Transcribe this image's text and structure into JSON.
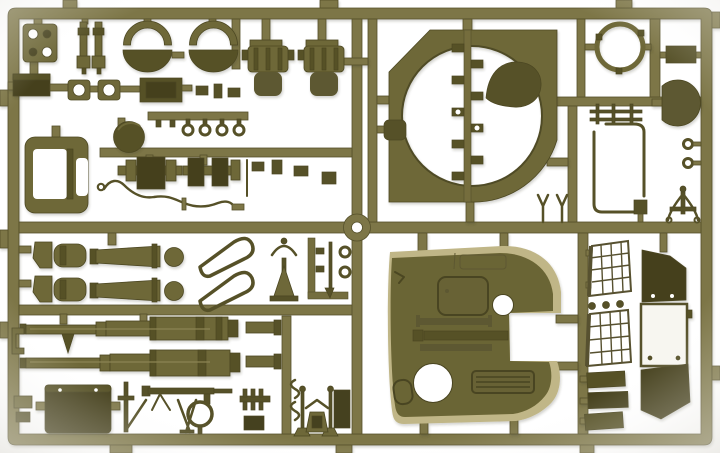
{
  "alt": "Photograph of an olive drab plastic model kit sprue (parts frame) for a military tank kit, molded parts attached to a rectangular runner grid on a white background",
  "palette": {
    "bg": "#ffffff",
    "vignette": "#ebebe7",
    "runner": "#7d7647",
    "runner_edge": "#55502a",
    "runner_mini": "#746d3e",
    "part": "#6e6839",
    "part_dark": "#565128",
    "part_deep": "#45411f",
    "shell_face": "#6b6534",
    "shell_detail": "#5d5830",
    "beige": "#c0b687",
    "outline": "#4c4722",
    "white": "#ffffff"
  },
  "parts": [
    {
      "label": "mounting plate with four holes"
    },
    {
      "label": "shock absorber rods"
    },
    {
      "label": "wheel half crescents and bowls, left pair"
    },
    {
      "label": "wheel half crescents and bowls, right pair"
    },
    {
      "label": "gun mantlet recoil cylinders"
    },
    {
      "label": "turret ring plate with circular opening"
    },
    {
      "label": "teardrop hatch cover"
    },
    {
      "label": "hatch ring hoop"
    },
    {
      "label": "commander hatch disc"
    },
    {
      "label": "mantlet drum shell"
    },
    {
      "label": "transmission block assemblies"
    },
    {
      "label": "tow cable wire"
    },
    {
      "label": "recuperator tubes"
    },
    {
      "label": "hollow shield outline parts"
    },
    {
      "label": "long gun barrel, upper"
    },
    {
      "label": "long gun barrel, lower"
    },
    {
      "label": "stowage box"
    },
    {
      "label": "machine gun, ring and tripod cluster"
    },
    {
      "label": "turret upper shell with hatch openings"
    },
    {
      "label": "mesh grille screen, upper"
    },
    {
      "label": "mesh grille screen, lower"
    },
    {
      "label": "armor side panels"
    },
    {
      "label": "stack of armor plates"
    },
    {
      "label": "small fittings and eyelets"
    }
  ]
}
